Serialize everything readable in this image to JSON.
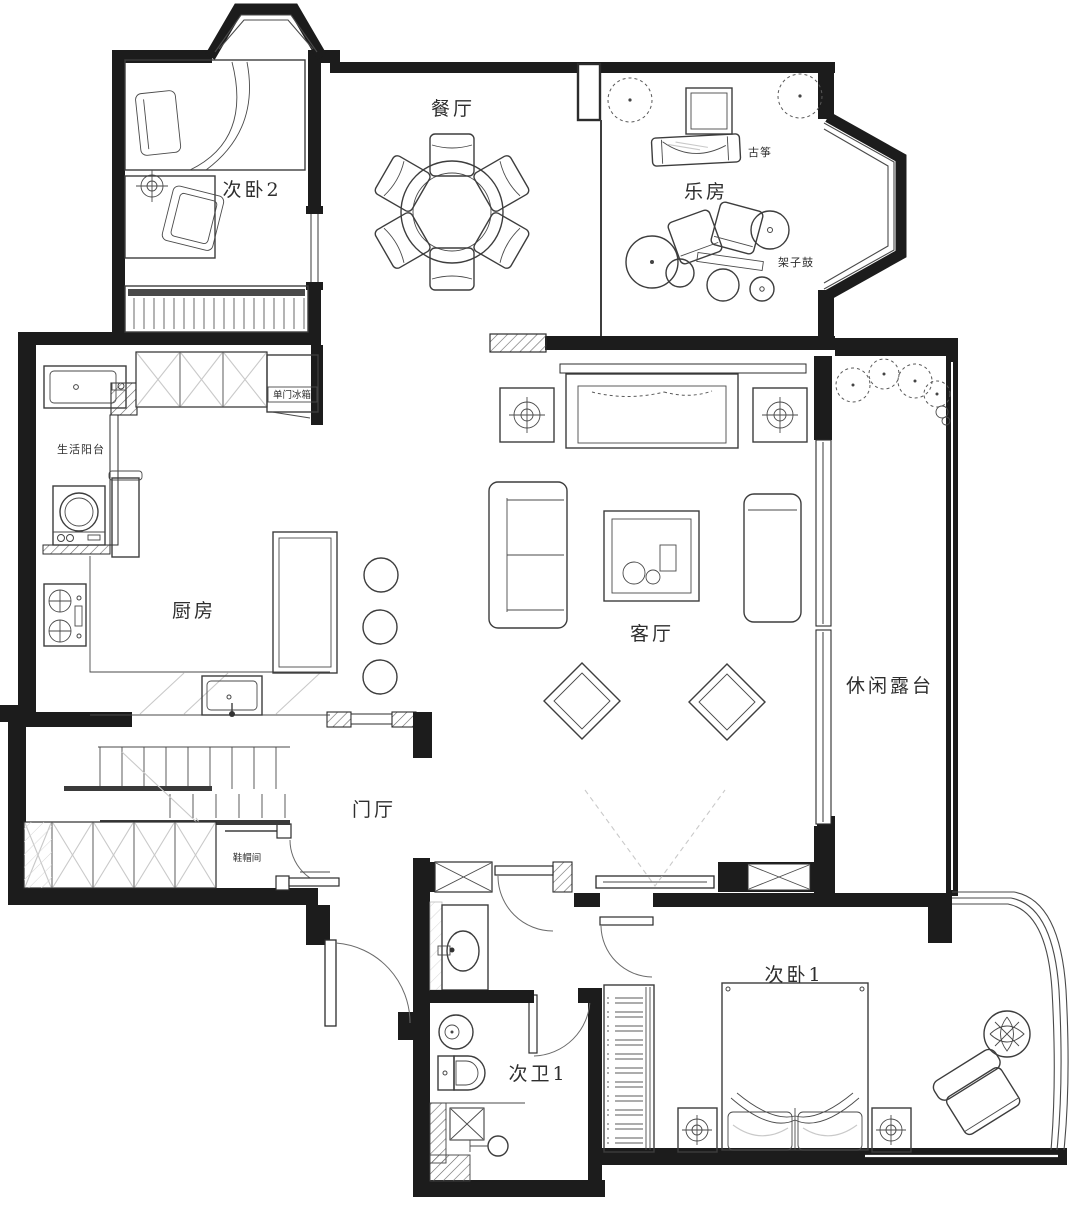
{
  "plan": {
    "type": "residential floor plan, black-and-white architectural line drawing",
    "colors": {
      "wall": "#1c1c1c",
      "furniture_line": "#3d3d3d",
      "paper": "#ffffff"
    }
  },
  "rooms": {
    "bedroom2": {
      "label": "次卧2"
    },
    "dining": {
      "label": "餐厅"
    },
    "music_room": {
      "label": "乐房"
    },
    "service_balcony": {
      "label": "生活阳台"
    },
    "kitchen": {
      "label": "厨房"
    },
    "living_room": {
      "label": "客厅"
    },
    "terrace": {
      "label": "休闲露台"
    },
    "foyer": {
      "label": "门厅"
    },
    "cloakroom": {
      "label": "鞋帽间"
    },
    "bathroom1": {
      "label": "次卫1"
    },
    "bedroom1": {
      "label": "次卧1"
    }
  },
  "annotations": {
    "fridge": "单门冰箱",
    "guzheng": "古筝",
    "drum_kit": "架子鼓"
  }
}
